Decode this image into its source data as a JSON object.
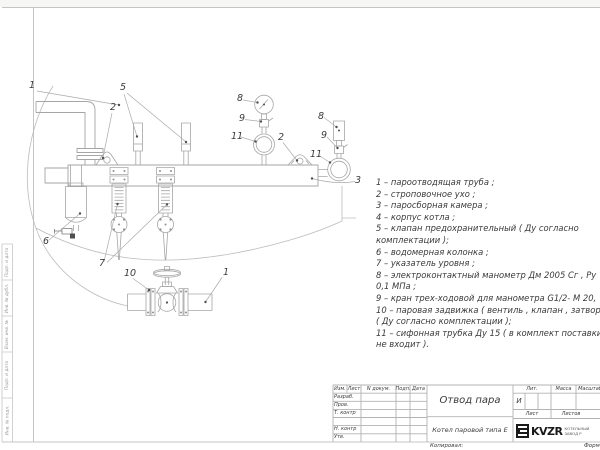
{
  "colors": {
    "line": "#a6a6a6",
    "faint": "#bcbcbc",
    "frame": "#c4c4c4",
    "tbline": "#b3b3b3",
    "text": "#3a3a3a",
    "dot": "#4f4f4f",
    "logo": "#1a1a1a"
  },
  "page": {
    "copied_label": "Копировал:",
    "format_label": "Формат"
  },
  "schematic": {
    "callouts": [
      {
        "label": "1",
        "x": 29,
        "y": 88
      },
      {
        "label": "5",
        "x": 120,
        "y": 90
      },
      {
        "label": "2",
        "x": 110,
        "y": 110
      },
      {
        "label": "8",
        "x": 237,
        "y": 101
      },
      {
        "label": "9",
        "x": 239,
        "y": 121
      },
      {
        "label": "11",
        "x": 231,
        "y": 139
      },
      {
        "label": "2",
        "x": 278,
        "y": 140
      },
      {
        "label": "8",
        "x": 318,
        "y": 119
      },
      {
        "label": "9",
        "x": 321,
        "y": 138
      },
      {
        "label": "11",
        "x": 310,
        "y": 157
      },
      {
        "label": "3",
        "x": 355,
        "y": 183
      },
      {
        "label": "6",
        "x": 43,
        "y": 244
      },
      {
        "label": "7",
        "x": 99,
        "y": 266
      },
      {
        "label": "10",
        "x": 124,
        "y": 276
      },
      {
        "label": "1",
        "x": 223,
        "y": 275
      }
    ],
    "legend_lines": [
      "1 –  пароотводящая труба ;",
      "2 –  строповочное ухо ;",
      "3 –  паросборная камера ;",
      "4 –  корпус котла ;",
      "5 –  клапан предохранительный  ( Ду согласно",
      "комплектации );",
      "6 –  водомерная колонка ;",
      "7 – указатель уровня ;",
      "8 – электроконтактный манометр  Дм 2005 Сг ,  Ру",
      "0,1  МПа ;",
      "9 –  кран трех-ходовой для манометра  G1/2- М 20,",
      "10 –  паровая задвижка  ( вентиль ,  клапан ,  затвор",
      "( Ду согласно комплектации );",
      "11 –  сифонная трубка Ду 15  ( в комплект поставки",
      "не входит )."
    ]
  },
  "title_block": {
    "header_cols": [
      "Изм.",
      "Лист",
      "N докум.",
      "Подп.",
      "Дата"
    ],
    "row_labels": [
      "Разраб.",
      "Пров.",
      "Т. контр",
      "",
      "Н. контр",
      "Утв."
    ],
    "title": "Отвод пара",
    "subtitle": "Котел паровой типа Е",
    "lit_label": "Лит.",
    "lit_value": "И",
    "mass_label": "Масса",
    "scale_label": "Масштаб",
    "sheet_label": "Лист",
    "sheets_label": "Листов",
    "logo_text": "KVZR",
    "logo_caption_line1": "КОТЕЛЬНЫЙ",
    "logo_caption_line2": "ЗАВОД Р"
  },
  "left_margin": {
    "cells": [
      "Подп. и дата",
      "Инв. № дубл.",
      "Взам. инв. №",
      "Подп. и дата",
      "Инв. № подл."
    ]
  }
}
